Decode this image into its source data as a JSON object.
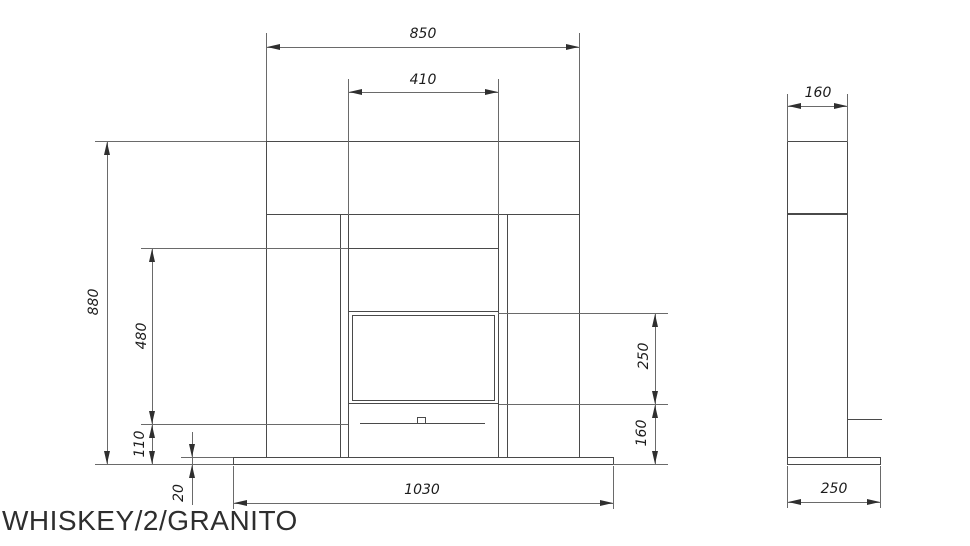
{
  "drawing_title": "WHISKEY/2/GRANITO",
  "front_view": {
    "dim_mantel_width": "850",
    "dim_opening_width": "410",
    "dim_overall_height": "880",
    "dim_opening_height": "480",
    "dim_burner_height": "110",
    "dim_base_thickness": "20",
    "dim_base_width": "1030",
    "dim_window_height": "250",
    "dim_window_floor": "160"
  },
  "side_view": {
    "dim_top_depth": "160",
    "dim_base_depth": "250"
  }
}
